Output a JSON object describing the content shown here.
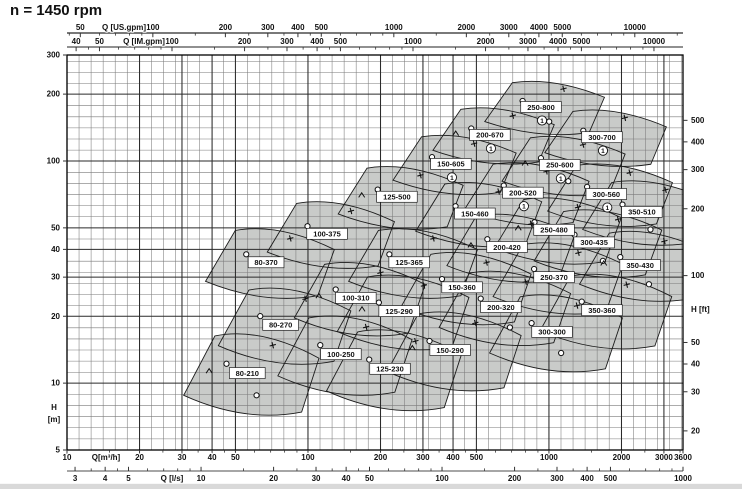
{
  "title": "n = 1450 rpm",
  "colors": {
    "field_fill": "#c9cbc9",
    "field_outline": "#1c1c1c",
    "grid_minor": "#7a7a7a",
    "grid_major": "#2a2a2a",
    "frame": "#000000",
    "axis_line": "#4d4d4d",
    "text": "#111111",
    "label_box_fill": "#ffffff",
    "label_box_border": "#222222",
    "footer_bar": "#d9d9d9"
  },
  "chart_data": {
    "type": "area",
    "title": "n = 1450 rpm",
    "scales": "log-log",
    "grid": "on",
    "marker_symbols": [
      "circle",
      "plus",
      "caret"
    ],
    "x_axes": [
      {
        "id": "us_gpm",
        "label": "Q [US.gpm]",
        "ticks": [
          50,
          100,
          200,
          300,
          400,
          500,
          1000,
          2000,
          3000,
          4000,
          5000,
          10000
        ]
      },
      {
        "id": "im_gpm",
        "label": "Q [IM.gpm]",
        "ticks": [
          40,
          50,
          100,
          200,
          300,
          400,
          500,
          1000,
          2000,
          3000,
          4000,
          5000,
          10000
        ]
      },
      {
        "id": "m3h",
        "label": "Q[m³/h]",
        "ticks": [
          10,
          20,
          30,
          40,
          50,
          100,
          200,
          300,
          400,
          500,
          1000,
          2000,
          3000,
          3600
        ],
        "range": [
          10,
          3600
        ]
      },
      {
        "id": "l_s",
        "label": "Q [l/s]",
        "ticks": [
          3,
          4,
          5,
          10,
          20,
          30,
          40,
          50,
          100,
          200,
          300,
          400,
          500,
          1000
        ]
      }
    ],
    "y_axes": [
      {
        "id": "h_m",
        "label_line1": "H",
        "label_line2": "[m]",
        "ticks": [
          300,
          200,
          100,
          50,
          40,
          30,
          20,
          10,
          5
        ],
        "range": [
          5,
          300
        ]
      },
      {
        "id": "h_ft",
        "label": "H [ft]",
        "ticks": [
          500,
          400,
          300,
          200,
          100,
          50,
          40,
          30,
          20
        ]
      }
    ],
    "pump_fields": [
      {
        "model": "250-800",
        "q_m3h": 927,
        "h_m": 175,
        "note": "1"
      },
      {
        "model": "200-670",
        "q_m3h": 569,
        "h_m": 131,
        "note": "1"
      },
      {
        "model": "300-700",
        "q_m3h": 1660,
        "h_m": 128,
        "note": "1"
      },
      {
        "model": "150-605",
        "q_m3h": 392,
        "h_m": 97,
        "note": "1"
      },
      {
        "model": "250-600",
        "q_m3h": 1110,
        "h_m": 96,
        "note": "1"
      },
      {
        "model": "200-520",
        "q_m3h": 780,
        "h_m": 72,
        "note": "1"
      },
      {
        "model": "300-560",
        "q_m3h": 1730,
        "h_m": 71,
        "note": "1"
      },
      {
        "model": "125-500",
        "q_m3h": 234,
        "h_m": 69,
        "note": null
      },
      {
        "model": "350-510",
        "q_m3h": 2430,
        "h_m": 59,
        "note": null
      },
      {
        "model": "150-460",
        "q_m3h": 493,
        "h_m": 58,
        "note": null
      },
      {
        "model": "250-480",
        "q_m3h": 1050,
        "h_m": 49,
        "note": null
      },
      {
        "model": "100-375",
        "q_m3h": 120,
        "h_m": 47,
        "note": null
      },
      {
        "model": "300-435",
        "q_m3h": 1540,
        "h_m": 43,
        "note": null
      },
      {
        "model": "200-420",
        "q_m3h": 670,
        "h_m": 41,
        "note": null
      },
      {
        "model": "80-370",
        "q_m3h": 67,
        "h_m": 35,
        "note": null
      },
      {
        "model": "125-365",
        "q_m3h": 263,
        "h_m": 35,
        "note": null
      },
      {
        "model": "350-430",
        "q_m3h": 2390,
        "h_m": 34,
        "note": null
      },
      {
        "model": "250-370",
        "q_m3h": 1050,
        "h_m": 30,
        "note": null
      },
      {
        "model": "150-360",
        "q_m3h": 436,
        "h_m": 27,
        "note": null
      },
      {
        "model": "100-310",
        "q_m3h": 158,
        "h_m": 24.2,
        "note": null
      },
      {
        "model": "200-320",
        "q_m3h": 632,
        "h_m": 22,
        "note": null
      },
      {
        "model": "350-360",
        "q_m3h": 1660,
        "h_m": 21.3,
        "note": null
      },
      {
        "model": "125-290",
        "q_m3h": 239,
        "h_m": 21.1,
        "note": null
      },
      {
        "model": "80-270",
        "q_m3h": 77,
        "h_m": 18.3,
        "note": null
      },
      {
        "model": "300-300",
        "q_m3h": 1030,
        "h_m": 17,
        "note": null
      },
      {
        "model": "150-290",
        "q_m3h": 389,
        "h_m": 14.1,
        "note": null
      },
      {
        "model": "100-250",
        "q_m3h": 137,
        "h_m": 13.5,
        "note": null
      },
      {
        "model": "125-230",
        "q_m3h": 219,
        "h_m": 11.6,
        "note": null
      },
      {
        "model": "80-210",
        "q_m3h": 56,
        "h_m": 11.1,
        "note": null
      }
    ]
  }
}
